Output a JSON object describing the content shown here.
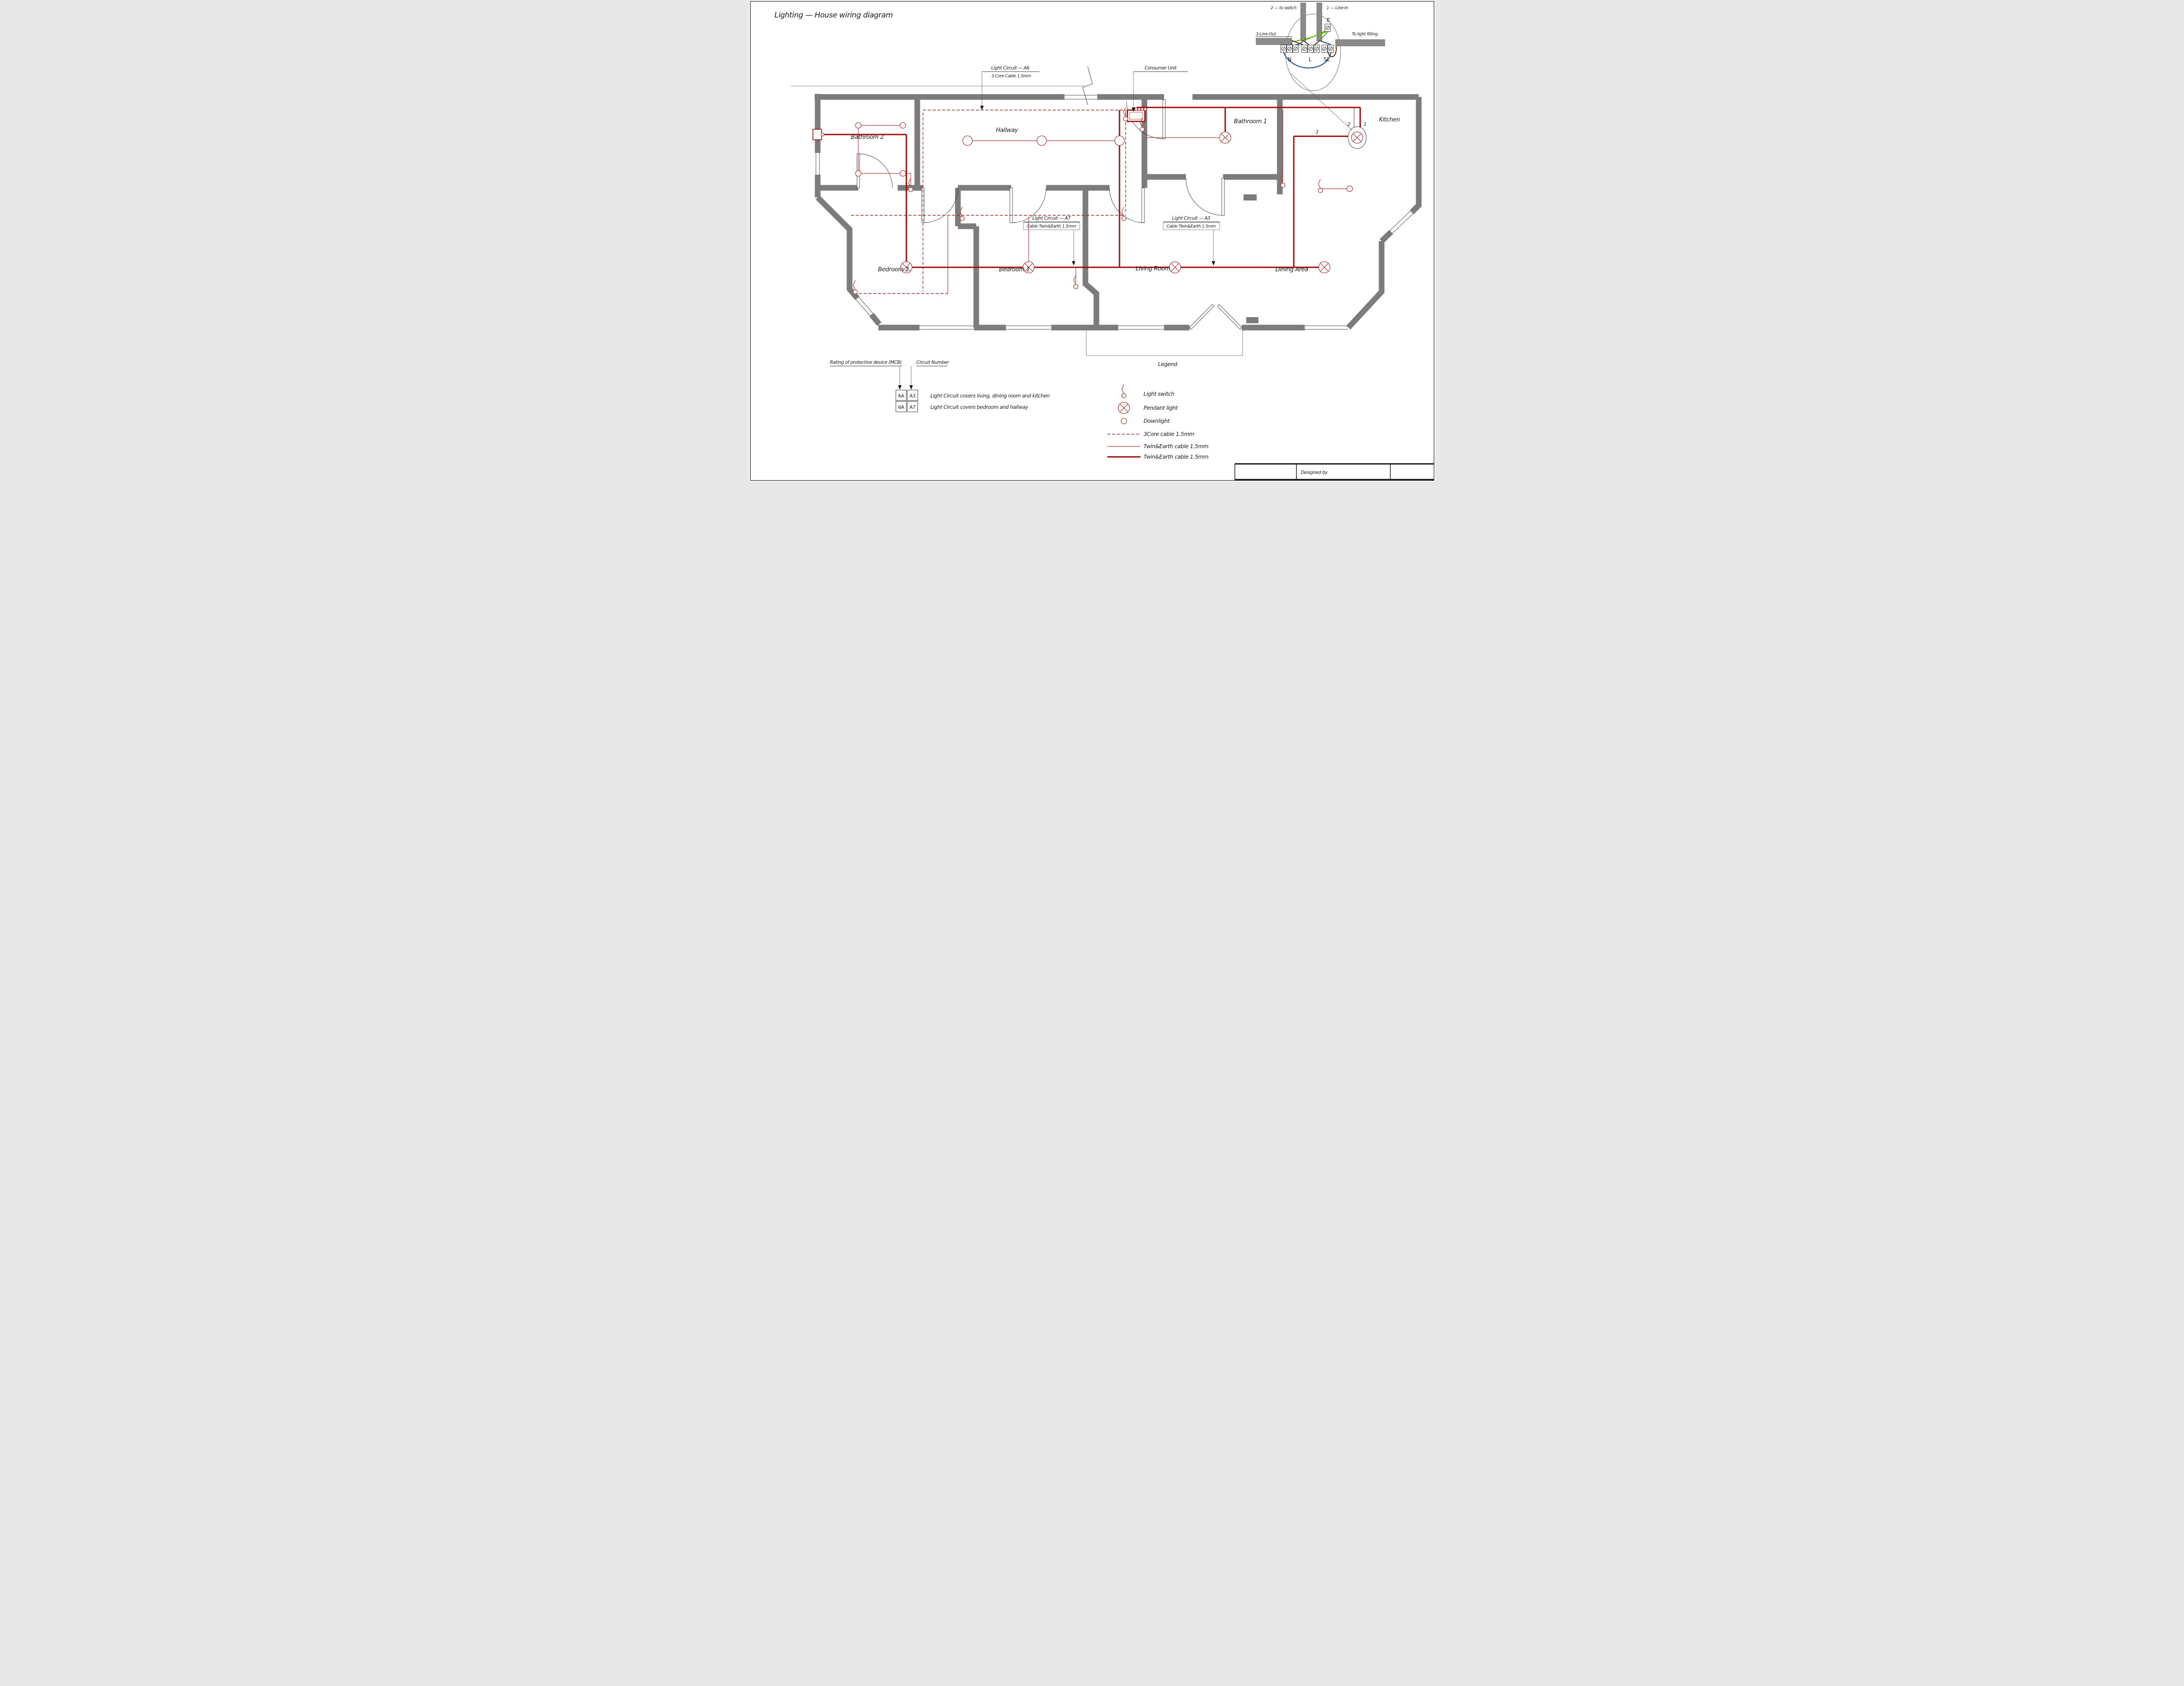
{
  "page": {
    "title": "Lighting — House wiring diagram",
    "designed_by_label": "Designed by"
  },
  "rooms": [
    {
      "id": "bathroom2",
      "label": "Bathroom 2"
    },
    {
      "id": "hallway",
      "label": "Hallway"
    },
    {
      "id": "bathroom1",
      "label": "Bathroom 1"
    },
    {
      "id": "kitchen",
      "label": "Kitchen"
    },
    {
      "id": "bedroom2",
      "label": "Bedroom 2"
    },
    {
      "id": "bedroom1",
      "label": "Bedroom 1"
    },
    {
      "id": "living_room",
      "label": "Living Room"
    },
    {
      "id": "dining_area",
      "label": "Dining Area"
    }
  ],
  "consumer_unit_label": "Consumer Unit",
  "circuit_annotations": [
    {
      "id": "a6",
      "line1": "Light Circuit — A6",
      "line2": "3 Core Cable 1.5mm"
    },
    {
      "id": "a7",
      "line1": "Light Circuit — A7",
      "line2": "Cable Twin&Earth 1.5mm"
    },
    {
      "id": "a3",
      "line1": "Light Circuit — A3",
      "line2": "Cable Twin&Earth 1.5mm"
    }
  ],
  "ceiling_rose": {
    "labels": {
      "to_switch": "2 — to switch",
      "line_in": "1 — Line-In",
      "line_out": "3-Line-Out",
      "to_light_fitting": "To light fitting",
      "earth": "E",
      "neutral": "N",
      "live": "L",
      "switched_live": "SL"
    }
  },
  "kitchen_wire_markers": {
    "m2": "2",
    "m1": "1",
    "m3": "3"
  },
  "mcb_note": {
    "heading_rating": "Rating of protective device (MCB)",
    "heading_circuit": "Circuit Number",
    "rows": [
      {
        "rating": "6A",
        "circuit": "A3",
        "description": "Light Circuit covers living, dining room and kitchen"
      },
      {
        "rating": "6A",
        "circuit": "A7",
        "description": "Light Circuit covers bedroom and hallway"
      }
    ]
  },
  "legend": {
    "title": "Legend",
    "items": [
      {
        "symbol": "light-switch",
        "label": "Light switch"
      },
      {
        "symbol": "pendant-light",
        "label": "Pendant light"
      },
      {
        "symbol": "downlight",
        "label": "Downlight"
      },
      {
        "symbol": "cable-3core-dashed",
        "label": "3Core cable 1.5mm"
      },
      {
        "symbol": "cable-twin-earth-thin",
        "label": "Twin&Earth cable 1.5mm"
      },
      {
        "symbol": "cable-twin-earth-thick",
        "label": "Twin&Earth cable 1.5mm"
      }
    ]
  },
  "colors": {
    "wall": "#7c7c7c",
    "wire_thick": "#a00000",
    "wire_thin": "#b03535",
    "wire_dashed": "#a02525",
    "earth_green": "#1e8f1e",
    "earth_yellow": "#ffee00",
    "neutral_blue": "#1c4f93",
    "live_brown": "#5f3010",
    "cable_gray": "#8a8a8a"
  }
}
